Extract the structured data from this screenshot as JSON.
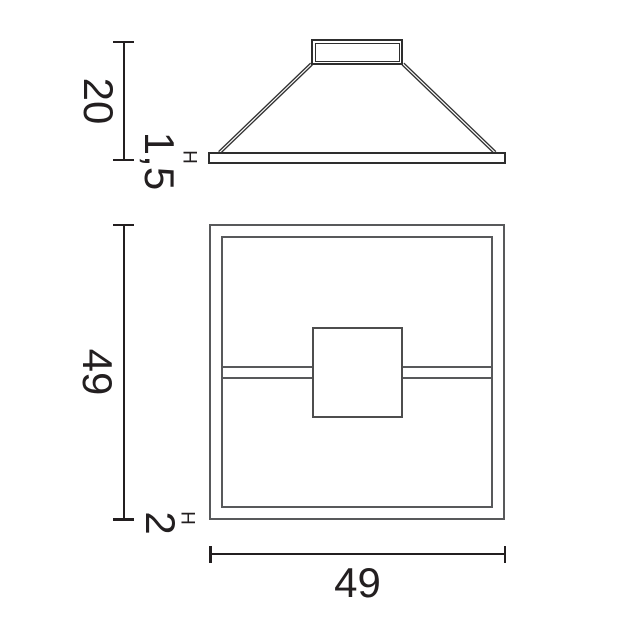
{
  "colors": {
    "bg": "#ffffff",
    "ink": "#231f20",
    "outline": "#2e2e2e",
    "frame": "#58595b",
    "box": "#4d4d4d"
  },
  "views": {
    "elevation": {
      "dims": {
        "suspension_drop": {
          "value": "20"
        },
        "profile_height": {
          "prefix": "H",
          "value": "1,5"
        }
      }
    },
    "plan": {
      "dims": {
        "depth": {
          "value": "49"
        },
        "frame_height": {
          "prefix": "H",
          "value": "2"
        },
        "width": {
          "value": "49"
        }
      }
    }
  }
}
